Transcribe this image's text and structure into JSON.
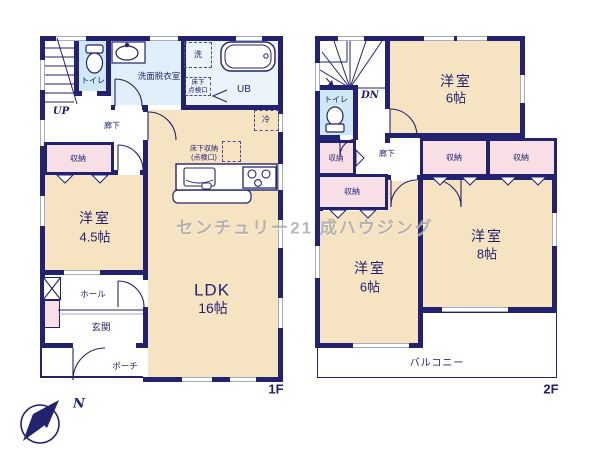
{
  "colors": {
    "wall": "#232270",
    "room_fill": "#f6e3c2",
    "closet_fill": "#f8dfe6",
    "toilet_fill": "#cfe8f6",
    "washroom_fill": "#e0effa",
    "bath_fill": "#ebf4fb",
    "window_line": "#a7adc6",
    "label_text": "#232270",
    "watermark_text": "#7d7d87"
  },
  "watermark": "センチュリー21 成ハウジング",
  "compass": {
    "north": "N"
  },
  "floor1": {
    "floor_label": "1F",
    "stairs": "UP",
    "toilet": "トイレ",
    "washroom": "洗面脱衣室",
    "washer": "洗",
    "hatch_line1": "床下",
    "hatch_line2": "点検口",
    "bath": "UB",
    "fridge": "冷",
    "corridor": "廊下",
    "closet": "収納",
    "room_name": "洋室",
    "room_size": "4.5帖",
    "underfloor_storage_line1": "床下収納",
    "underfloor_storage_line2": "(点検口)",
    "ldk_name": "LDK",
    "ldk_size": "16帖",
    "hall": "ホール",
    "entrance": "玄関",
    "porch": "ポーチ"
  },
  "floor2": {
    "floor_label": "2F",
    "stairs": "DN",
    "toilet": "トイレ",
    "corridor": "廊下",
    "closet_a": "収納",
    "closet_b": "収納",
    "closet_c": "収納",
    "closet_d": "収納",
    "room_top_name": "洋室",
    "room_top_size": "6帖",
    "room_left_name": "洋室",
    "room_left_size": "6帖",
    "room_right_name": "洋室",
    "room_right_size": "8帖",
    "balcony": "バルコニー"
  }
}
